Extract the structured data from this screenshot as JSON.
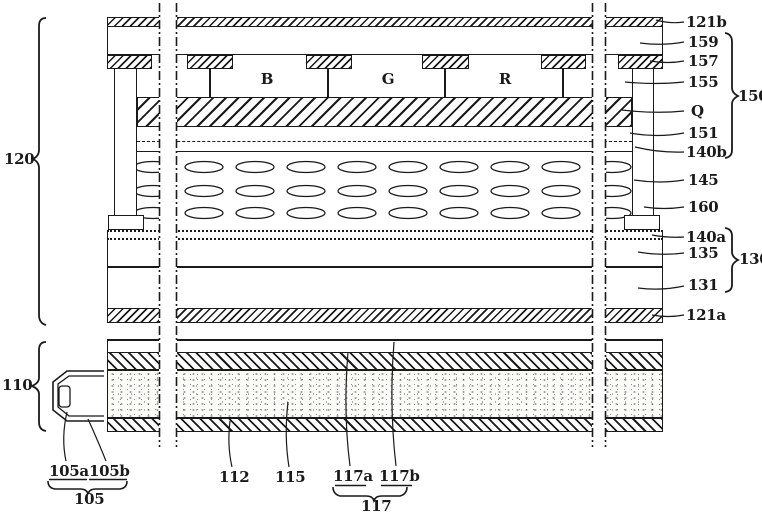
{
  "figure": {
    "description": "Patent-style cross-section line drawing of a liquid crystal display panel over an edge-lit backlight unit",
    "background": "#ffffff",
    "line_color": "#1a1a1a"
  },
  "reference_labels": {
    "panel_group": "120",
    "backlight_group": "110",
    "upper_group": "150",
    "lower_group": "130",
    "lamp_group": "105",
    "sheet_group": "117",
    "121b": "121b",
    "159": "159",
    "157": "157",
    "155": "155",
    "Q": "Q",
    "151": "151",
    "140b": "140b",
    "145": "145",
    "160": "160",
    "140a": "140a",
    "135": "135",
    "131": "131",
    "121a": "121a",
    "112": "112",
    "115": "115",
    "117a": "117a",
    "117b": "117b",
    "105a": "105a",
    "105b": "105b"
  },
  "color_filter_letters": {
    "b": "B",
    "g": "G",
    "r": "R"
  }
}
